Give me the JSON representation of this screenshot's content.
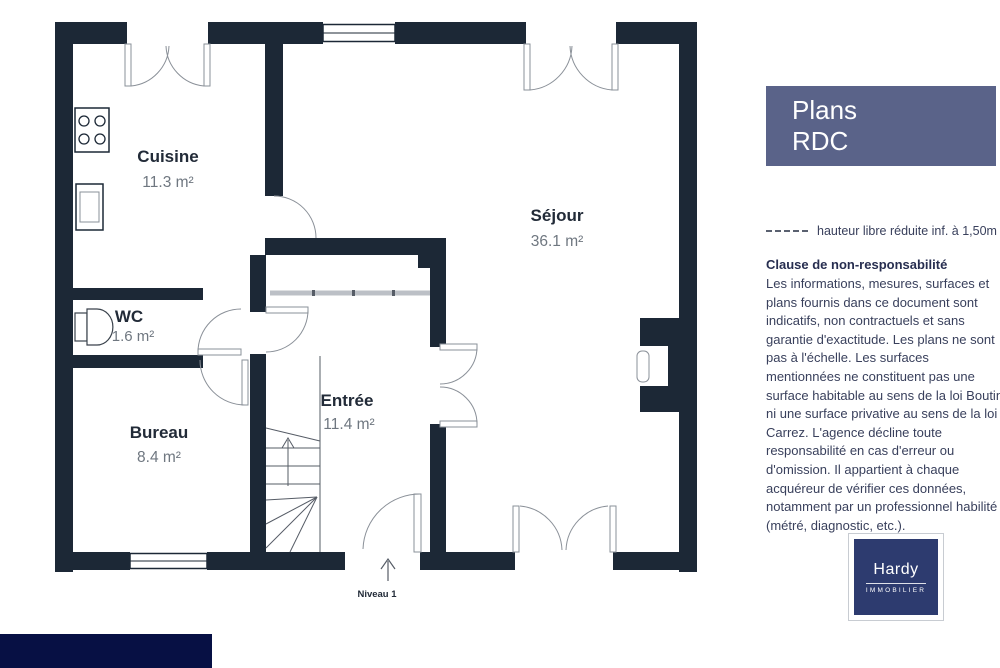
{
  "plan": {
    "wall_color": "#1c2836",
    "rooms": [
      {
        "name": "Cuisine",
        "area": "11.3 m²"
      },
      {
        "name": "Séjour",
        "area": "36.1 m²"
      },
      {
        "name": "WC",
        "area": "1.6 m²"
      },
      {
        "name": "Bureau",
        "area": "8.4 m²"
      },
      {
        "name": "Entrée",
        "area": "11.4 m²"
      }
    ],
    "level_label": "Niveau 1"
  },
  "sidebar": {
    "title": {
      "line1": "Plans",
      "line2": "RDC",
      "bg_color": "#5a6389"
    },
    "legend": {
      "symbol": "dashed-line",
      "label": "hauteur libre réduite inf. à 1,50m"
    },
    "disclaimer": {
      "heading": "Clause de non-responsabilité",
      "body": "Les informations, mesures, surfaces et plans fournis dans ce document sont indicatifs, non contractuels et sans garantie d'exactitude. Les plans ne sont pas à l'échelle. Les surfaces mentionnées ne constituent pas une surface habitable au sens de la loi Boutin ni une surface privative au sens de la loi Carrez. L'agence décline toute responsabilité en cas d'erreur ou d'omission. Il appartient à chaque acquéreur de vérifier ces données, notamment par un professionnel habilité (métré, diagnostic, etc.)."
    },
    "logo": {
      "name": "Hardy",
      "subtitle": "IMMOBILIER",
      "bg_color": "#2d3b6f"
    }
  },
  "footer": {
    "bar_color": "#071044"
  }
}
